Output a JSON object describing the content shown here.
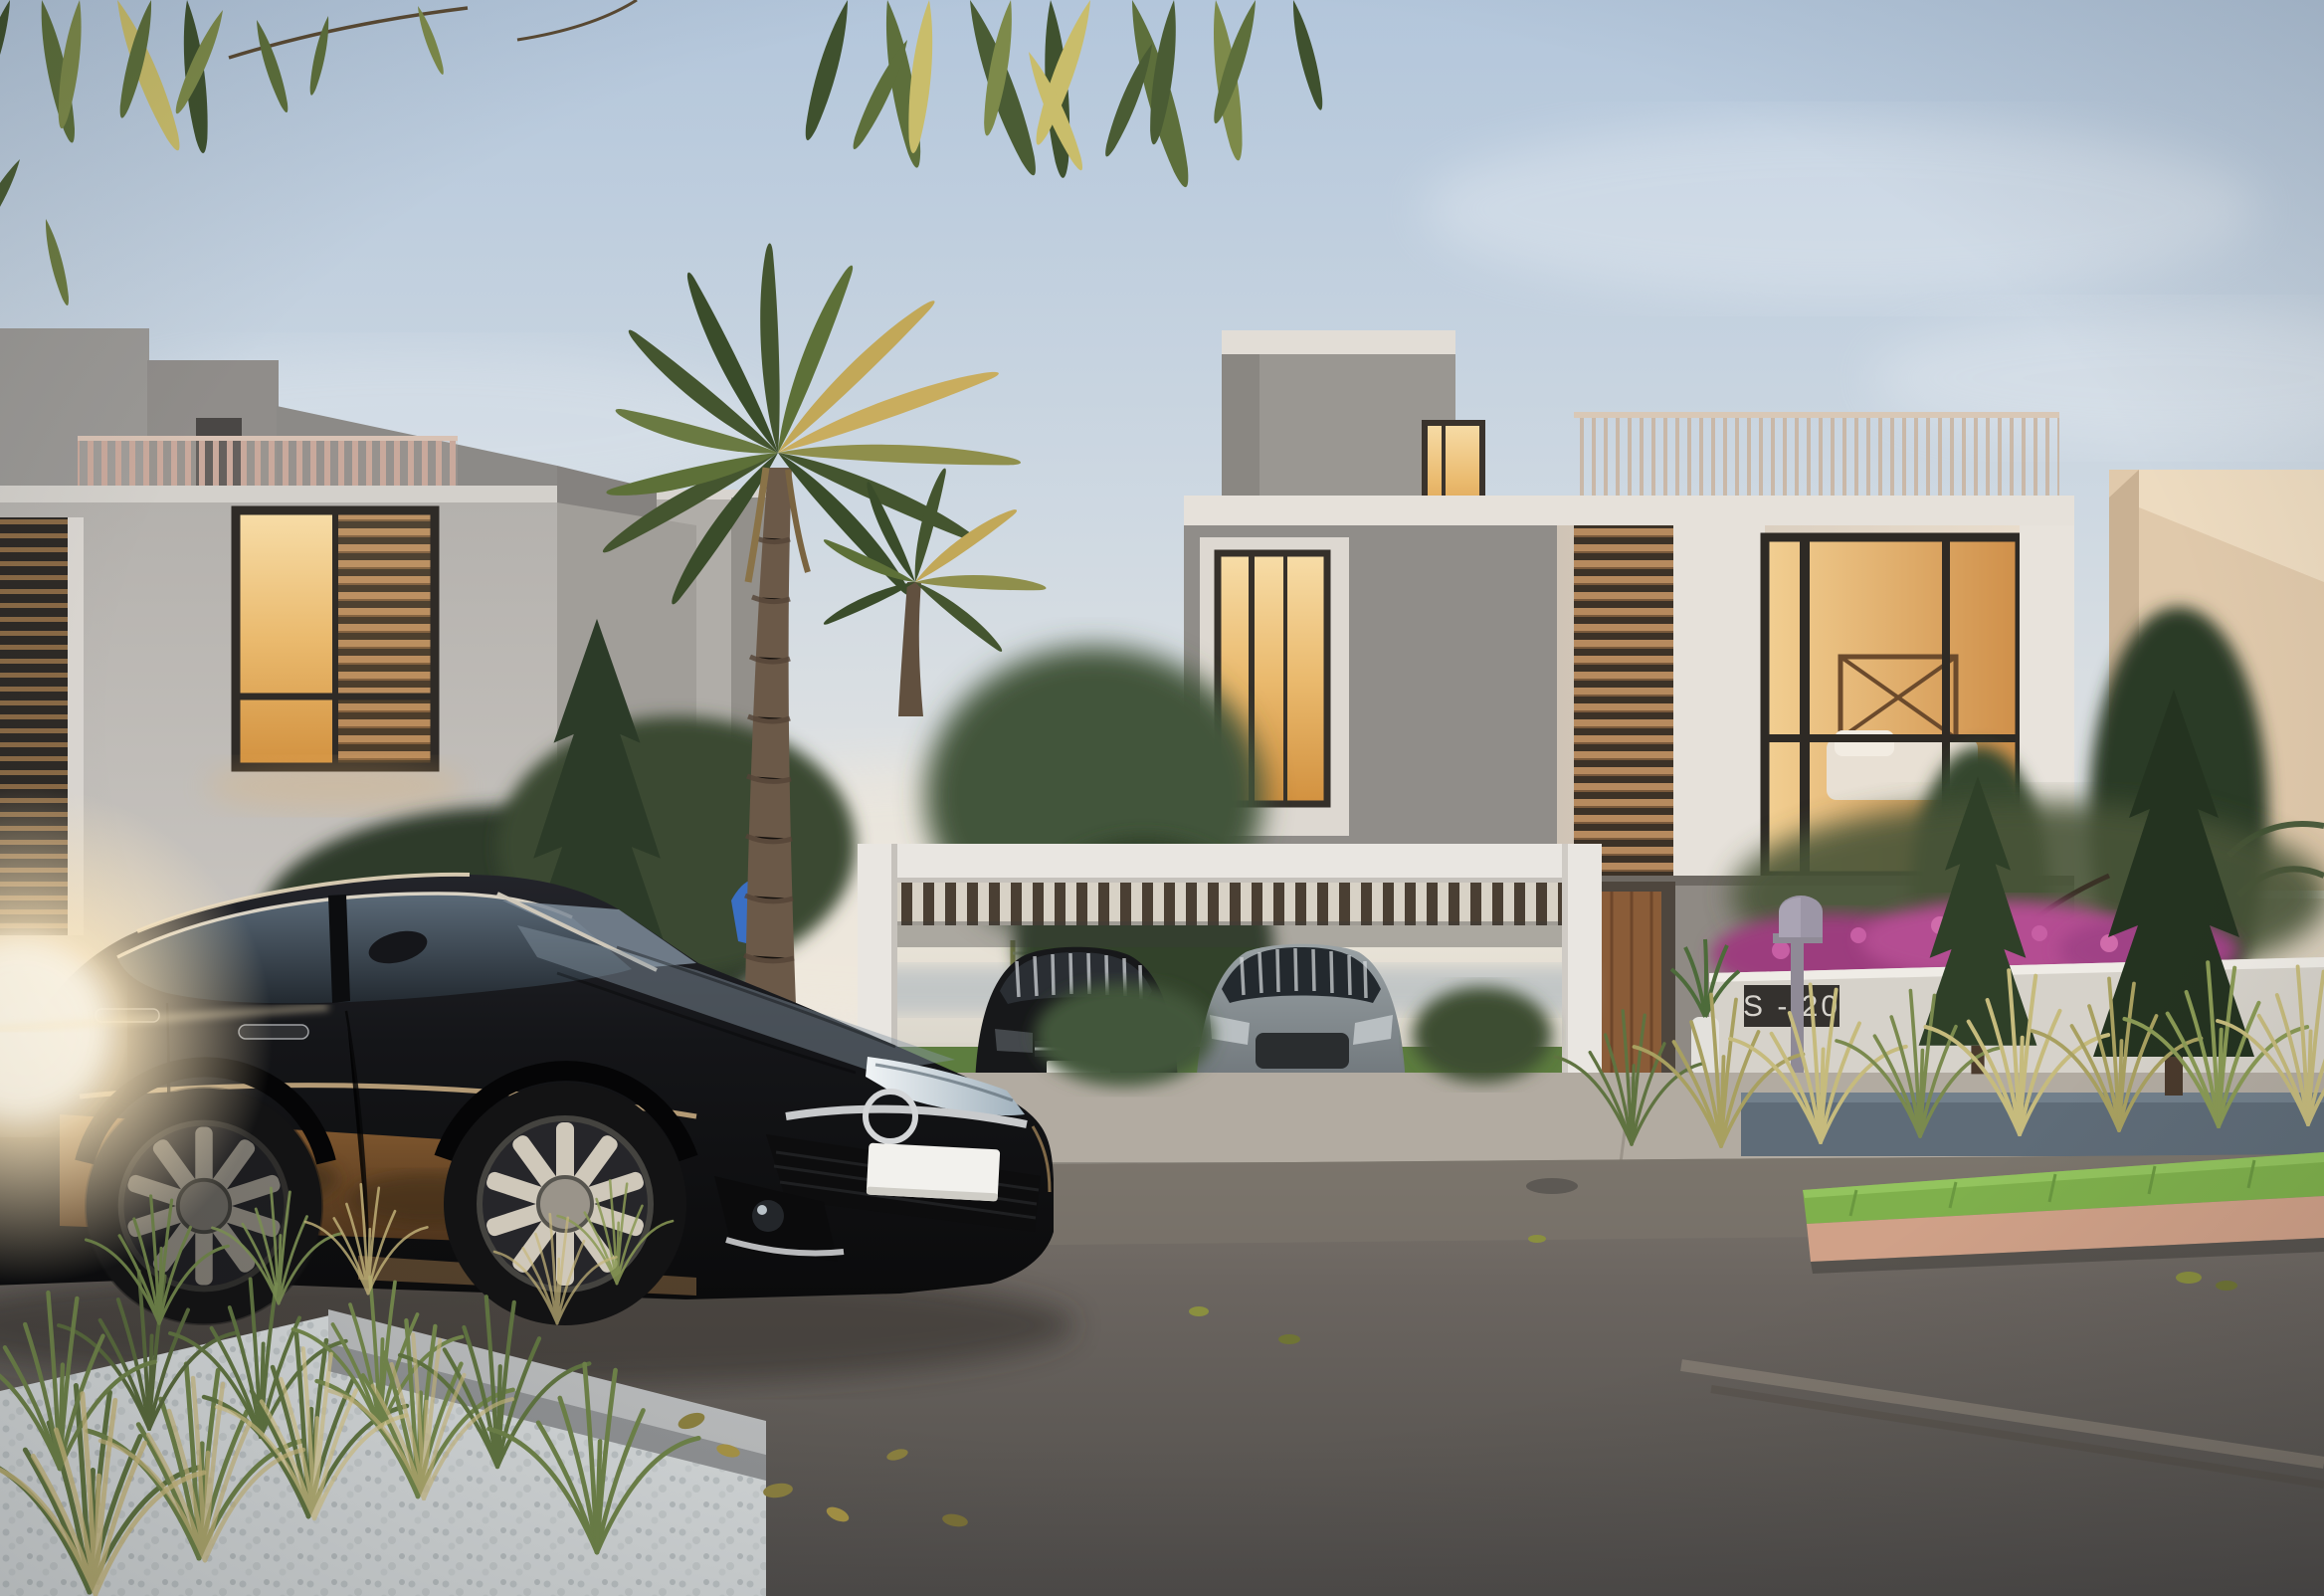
{
  "meta": {
    "domain": "Natural-Image",
    "description": "Dusk 3D architectural rendering of a modern villa street: black sedan in foreground, two cars under a white carport, palm and cypress landscaping, lit interiors, unit sign on garden wall"
  },
  "sign": {
    "label": "S - 20"
  },
  "vehicles": {
    "foreground_car": {
      "type": "black sedan",
      "license_plate": ""
    },
    "carport_left_car": {
      "type": "black compact car",
      "license_plate": ""
    },
    "carport_right_car": {
      "type": "grey sedan",
      "license_plate": ""
    }
  },
  "buildings": {
    "left_villa": "grey concrete villa with warm louvered window and rooftop slat railing",
    "right_villa": "cream villa with corner bedroom window, wood louvers and roof-terrace railing",
    "far_right_building": "beige neighbouring building behind boundary wall"
  },
  "landscape": {
    "palm_trees": 2,
    "cypress_trees": 3,
    "mailbox": "kerbside post mailbox",
    "flowers": "magenta bougainvillea over garden wall",
    "foreground_planting": "ornamental grasses in white gravel bed",
    "road_median": "green grass strip with pink kerb",
    "playground": "blue slide glimpsed behind foreground car",
    "background": "lake view with lawn behind carport"
  },
  "lighting": {
    "time_of_day": "dusk",
    "sun_glare": "low sun flare at left edge",
    "windows": "warm interior lighting"
  },
  "palette": {
    "sky_top": "#b3c6db",
    "sky_horizon": "#f1e9dc",
    "concrete_light": "#c4c1bd",
    "concrete_mid": "#9a9793",
    "concrete_dark": "#85827f",
    "cream_wall": "#e3d8c9",
    "window_warm": "#eaba6e",
    "wood_slat": "#b68a5e",
    "rail_pink": "#c9a99c",
    "palm_green": "#44552f",
    "palm_gold": "#c2a858",
    "pine_green": "#2c3b28",
    "carport_white": "#e9e6e1",
    "road": "#635e5a",
    "sidewalk": "#b5ada2",
    "gravel": "#d0d4d5",
    "median_grass": "#7fb04c",
    "median_kerb": "#d0a188",
    "car_black": "#111214",
    "car_bronze": "#8f6134",
    "sun_glare": "#fff3da",
    "plaque": "#34312e",
    "plaque_text": "#d6d3cd",
    "mailbox": "#9c96a6",
    "bougainvillea": "#b44d92",
    "wall_bluegrey": "#5f6c78",
    "lake": "#e9e3d8",
    "lawn": "#5d7d3f",
    "glass_reflection": "#7c8b99"
  }
}
